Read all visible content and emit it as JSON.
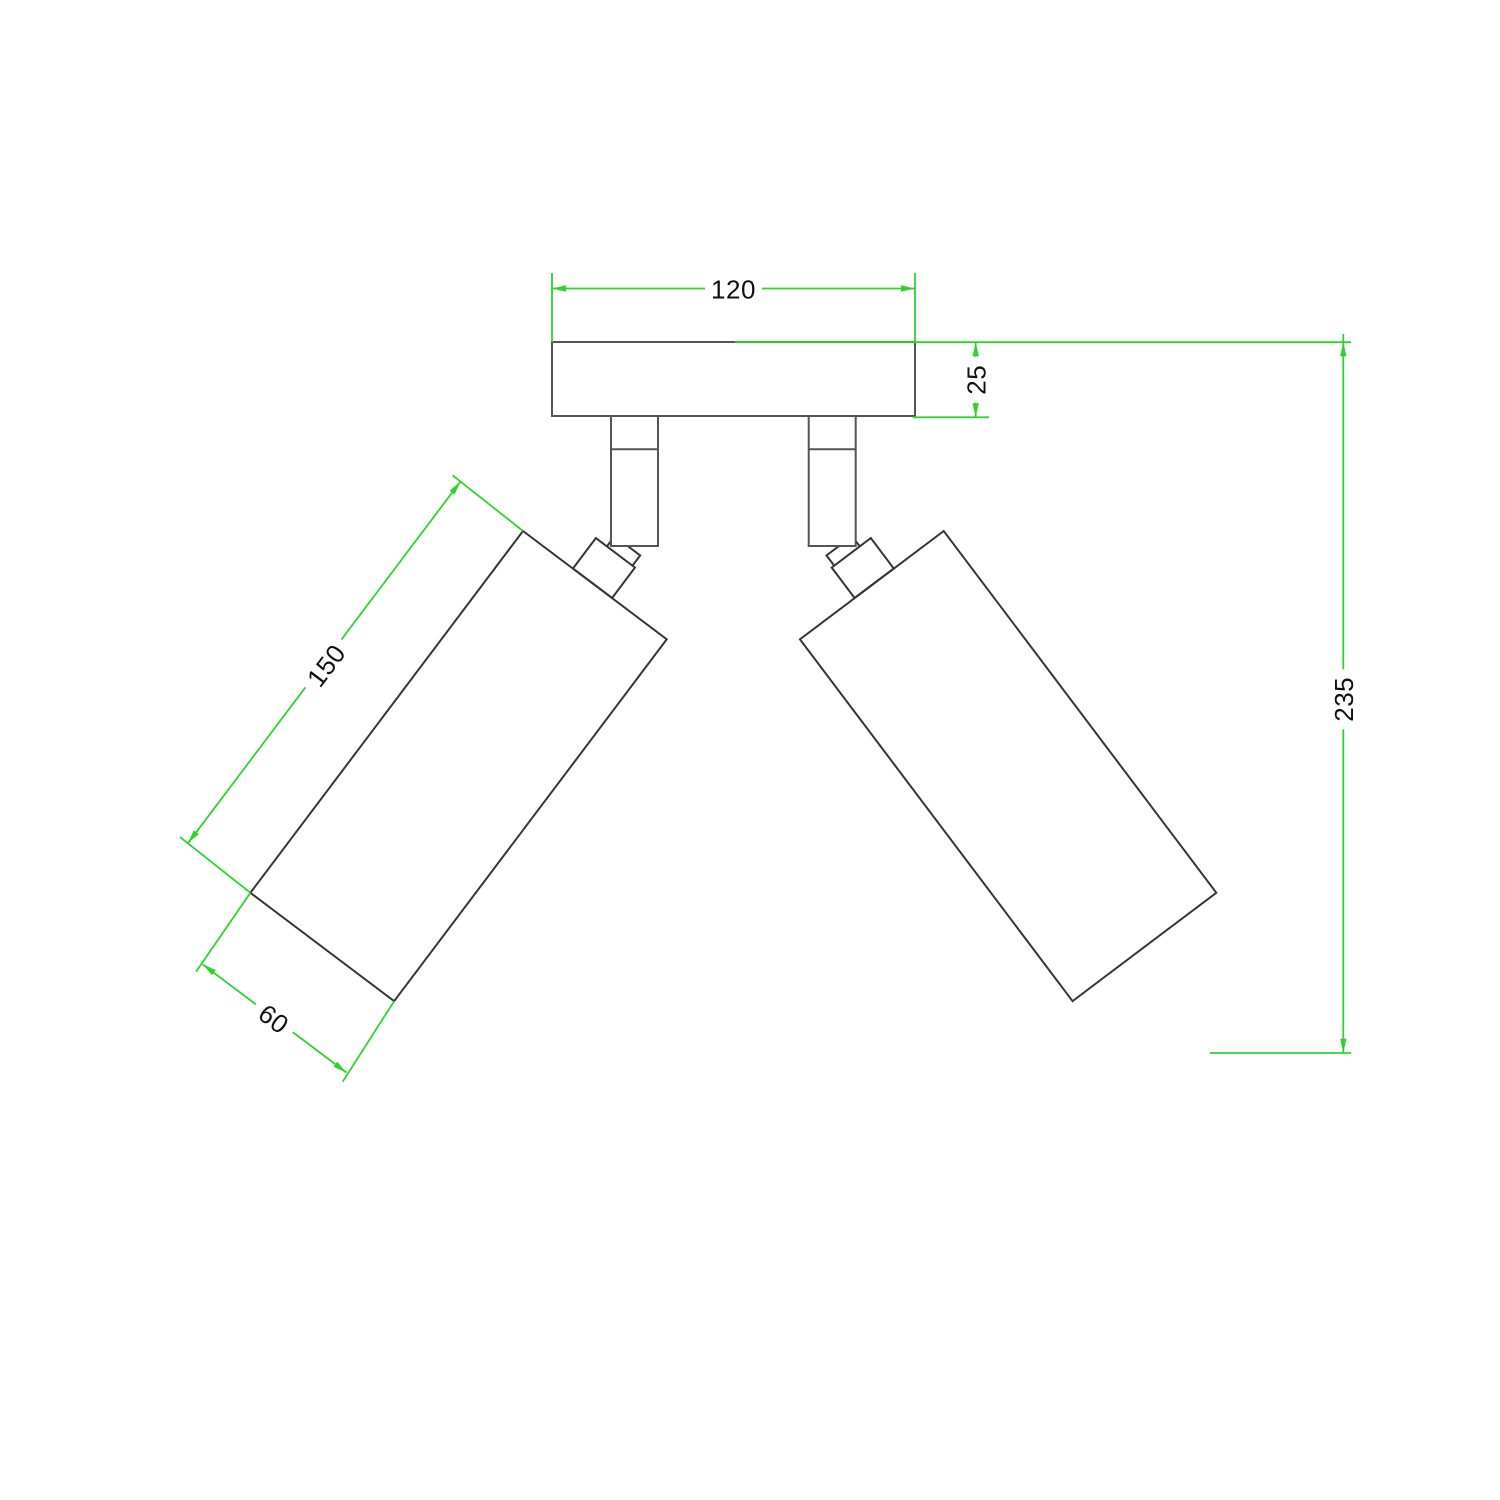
{
  "drawing": {
    "type": "technical-dimension-drawing",
    "view": "front-elevation-dual-spotlight-ceiling-fixture",
    "dimension_labels": {
      "plate_width": "120",
      "plate_thickness": "25",
      "body_length": "150",
      "body_width": "60",
      "overall_height": "235"
    },
    "colors": {
      "background": "#ffffff",
      "dimension": "#2ed32e",
      "outline": "#555555",
      "part": "#363636",
      "label": "#111111"
    }
  }
}
